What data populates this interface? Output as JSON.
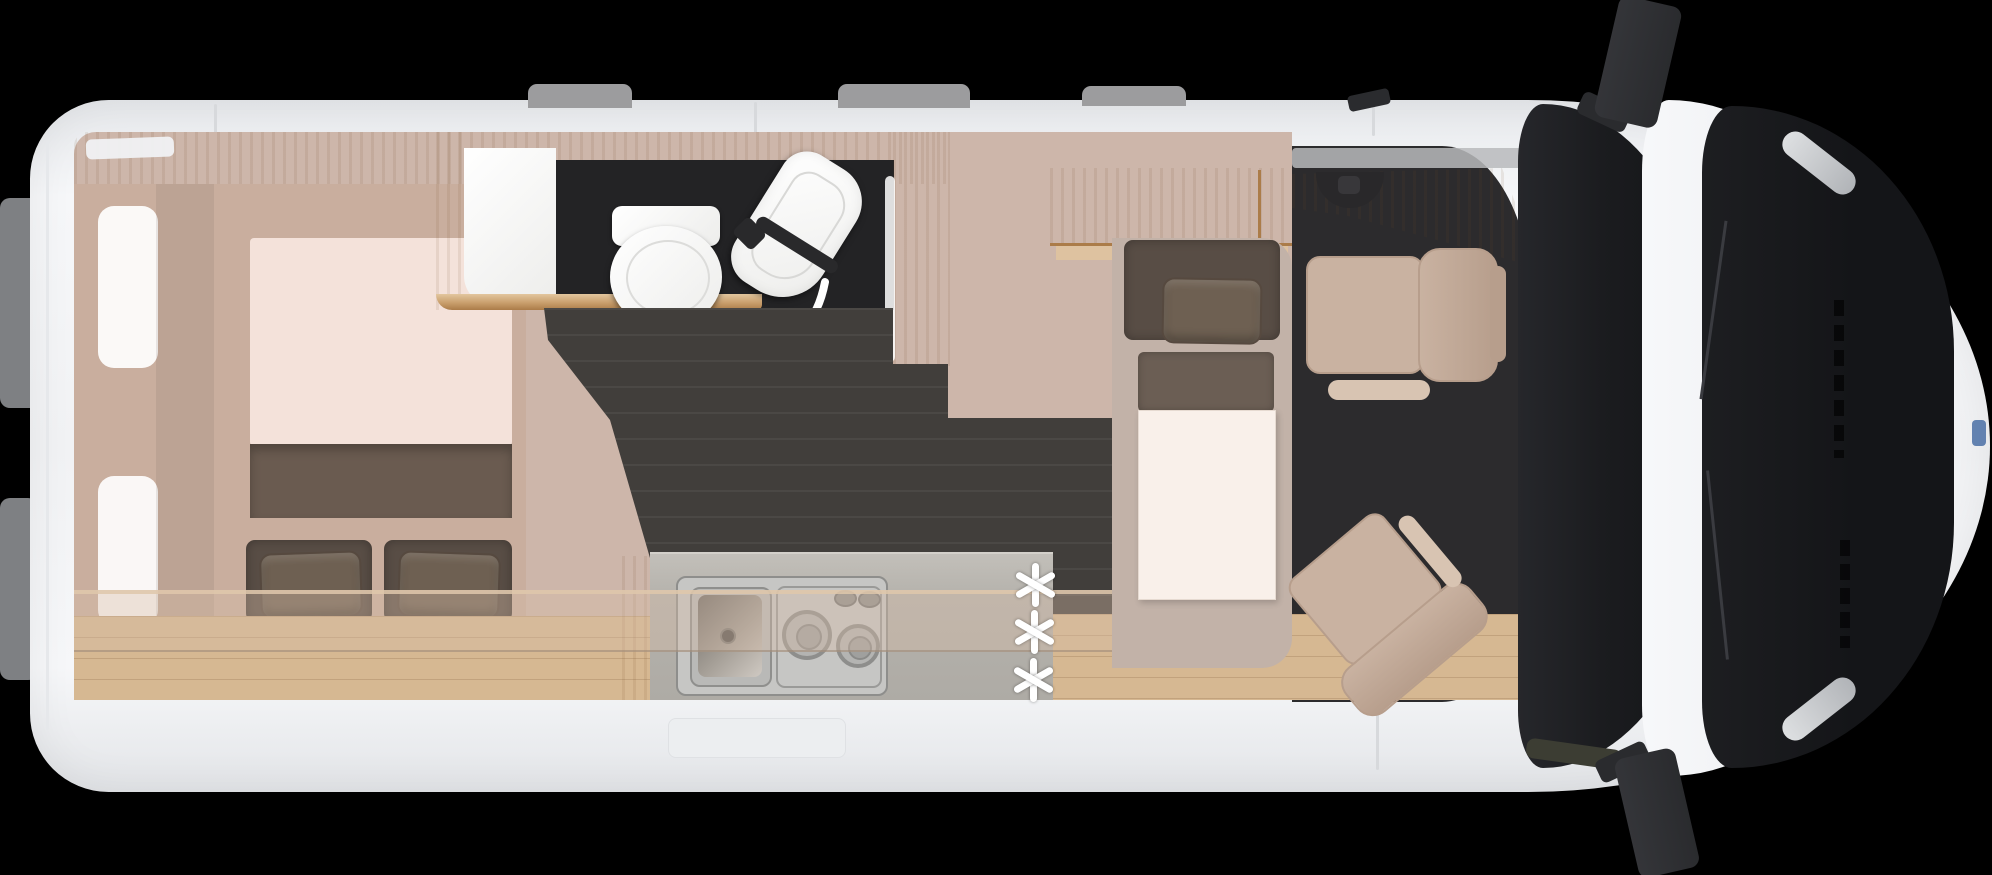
{
  "meta": {
    "type": "vehicle-floor-plan",
    "view": "top-down",
    "subject": "camper-van interior layout, cab at right, rear at left"
  },
  "palette": {
    "bg": "#000000",
    "bodyEdge": "#d7d9dc",
    "roofTab": "#9c9c9e",
    "rearTab": "#7e8083",
    "wood": "#c99f6d",
    "woodDark": "#ab7c49",
    "woodLight": "#e2c69e",
    "oak": "#d6b892",
    "wall": "#cdb6aa",
    "bedBase": "#c9ae9e",
    "mattress": "#f4e2da",
    "blanket": "#6a5b50",
    "pillow": "#6e6052",
    "cushion": "#584d45",
    "darkFloor": "#413e3b",
    "bathFloor": "#232325",
    "counter": "#b5b2ac",
    "steel": "#c6c6c4",
    "steelDark": "#8e8e8c",
    "taupe": "#c2b2a8",
    "table": "#f9f0ea",
    "seat": "#c9b2a1",
    "seatDark": "#b79e8c",
    "seatTrim": "#d8c4b2",
    "cabFloor": "#2c2b2d",
    "glass": "#1f2023",
    "hood": "#141518",
    "mirror": "#2a2b2e",
    "arrow": "#ffffff",
    "badge": "#4a6fa5"
  },
  "symbols": {
    "optional_marker": "✳",
    "optional_marker_count": 3
  },
  "inventory": {
    "bedroom": [
      "transverse-bed",
      "mattress",
      "blanket",
      "pillow",
      "pillow",
      "wardrobe-shelf",
      "rear-door-panels"
    ],
    "bathroom": [
      "toilet",
      "fold-away-sink",
      "shower-floor",
      "swing-arrow"
    ],
    "kitchen": [
      "counter",
      "sink-basin",
      "two-burner-hob",
      "hob-knobs"
    ],
    "dinette": [
      "overhead-cabinet",
      "bench-seat",
      "pillow",
      "table"
    ],
    "cab": [
      "dashboard",
      "steering-wheel",
      "driver-swivel-seat",
      "passenger-swivel-seat"
    ],
    "exterior": [
      "roof-vents",
      "side-mirrors",
      "antenna",
      "windshield",
      "hood-with-wipers",
      "grille",
      "headlights"
    ]
  }
}
